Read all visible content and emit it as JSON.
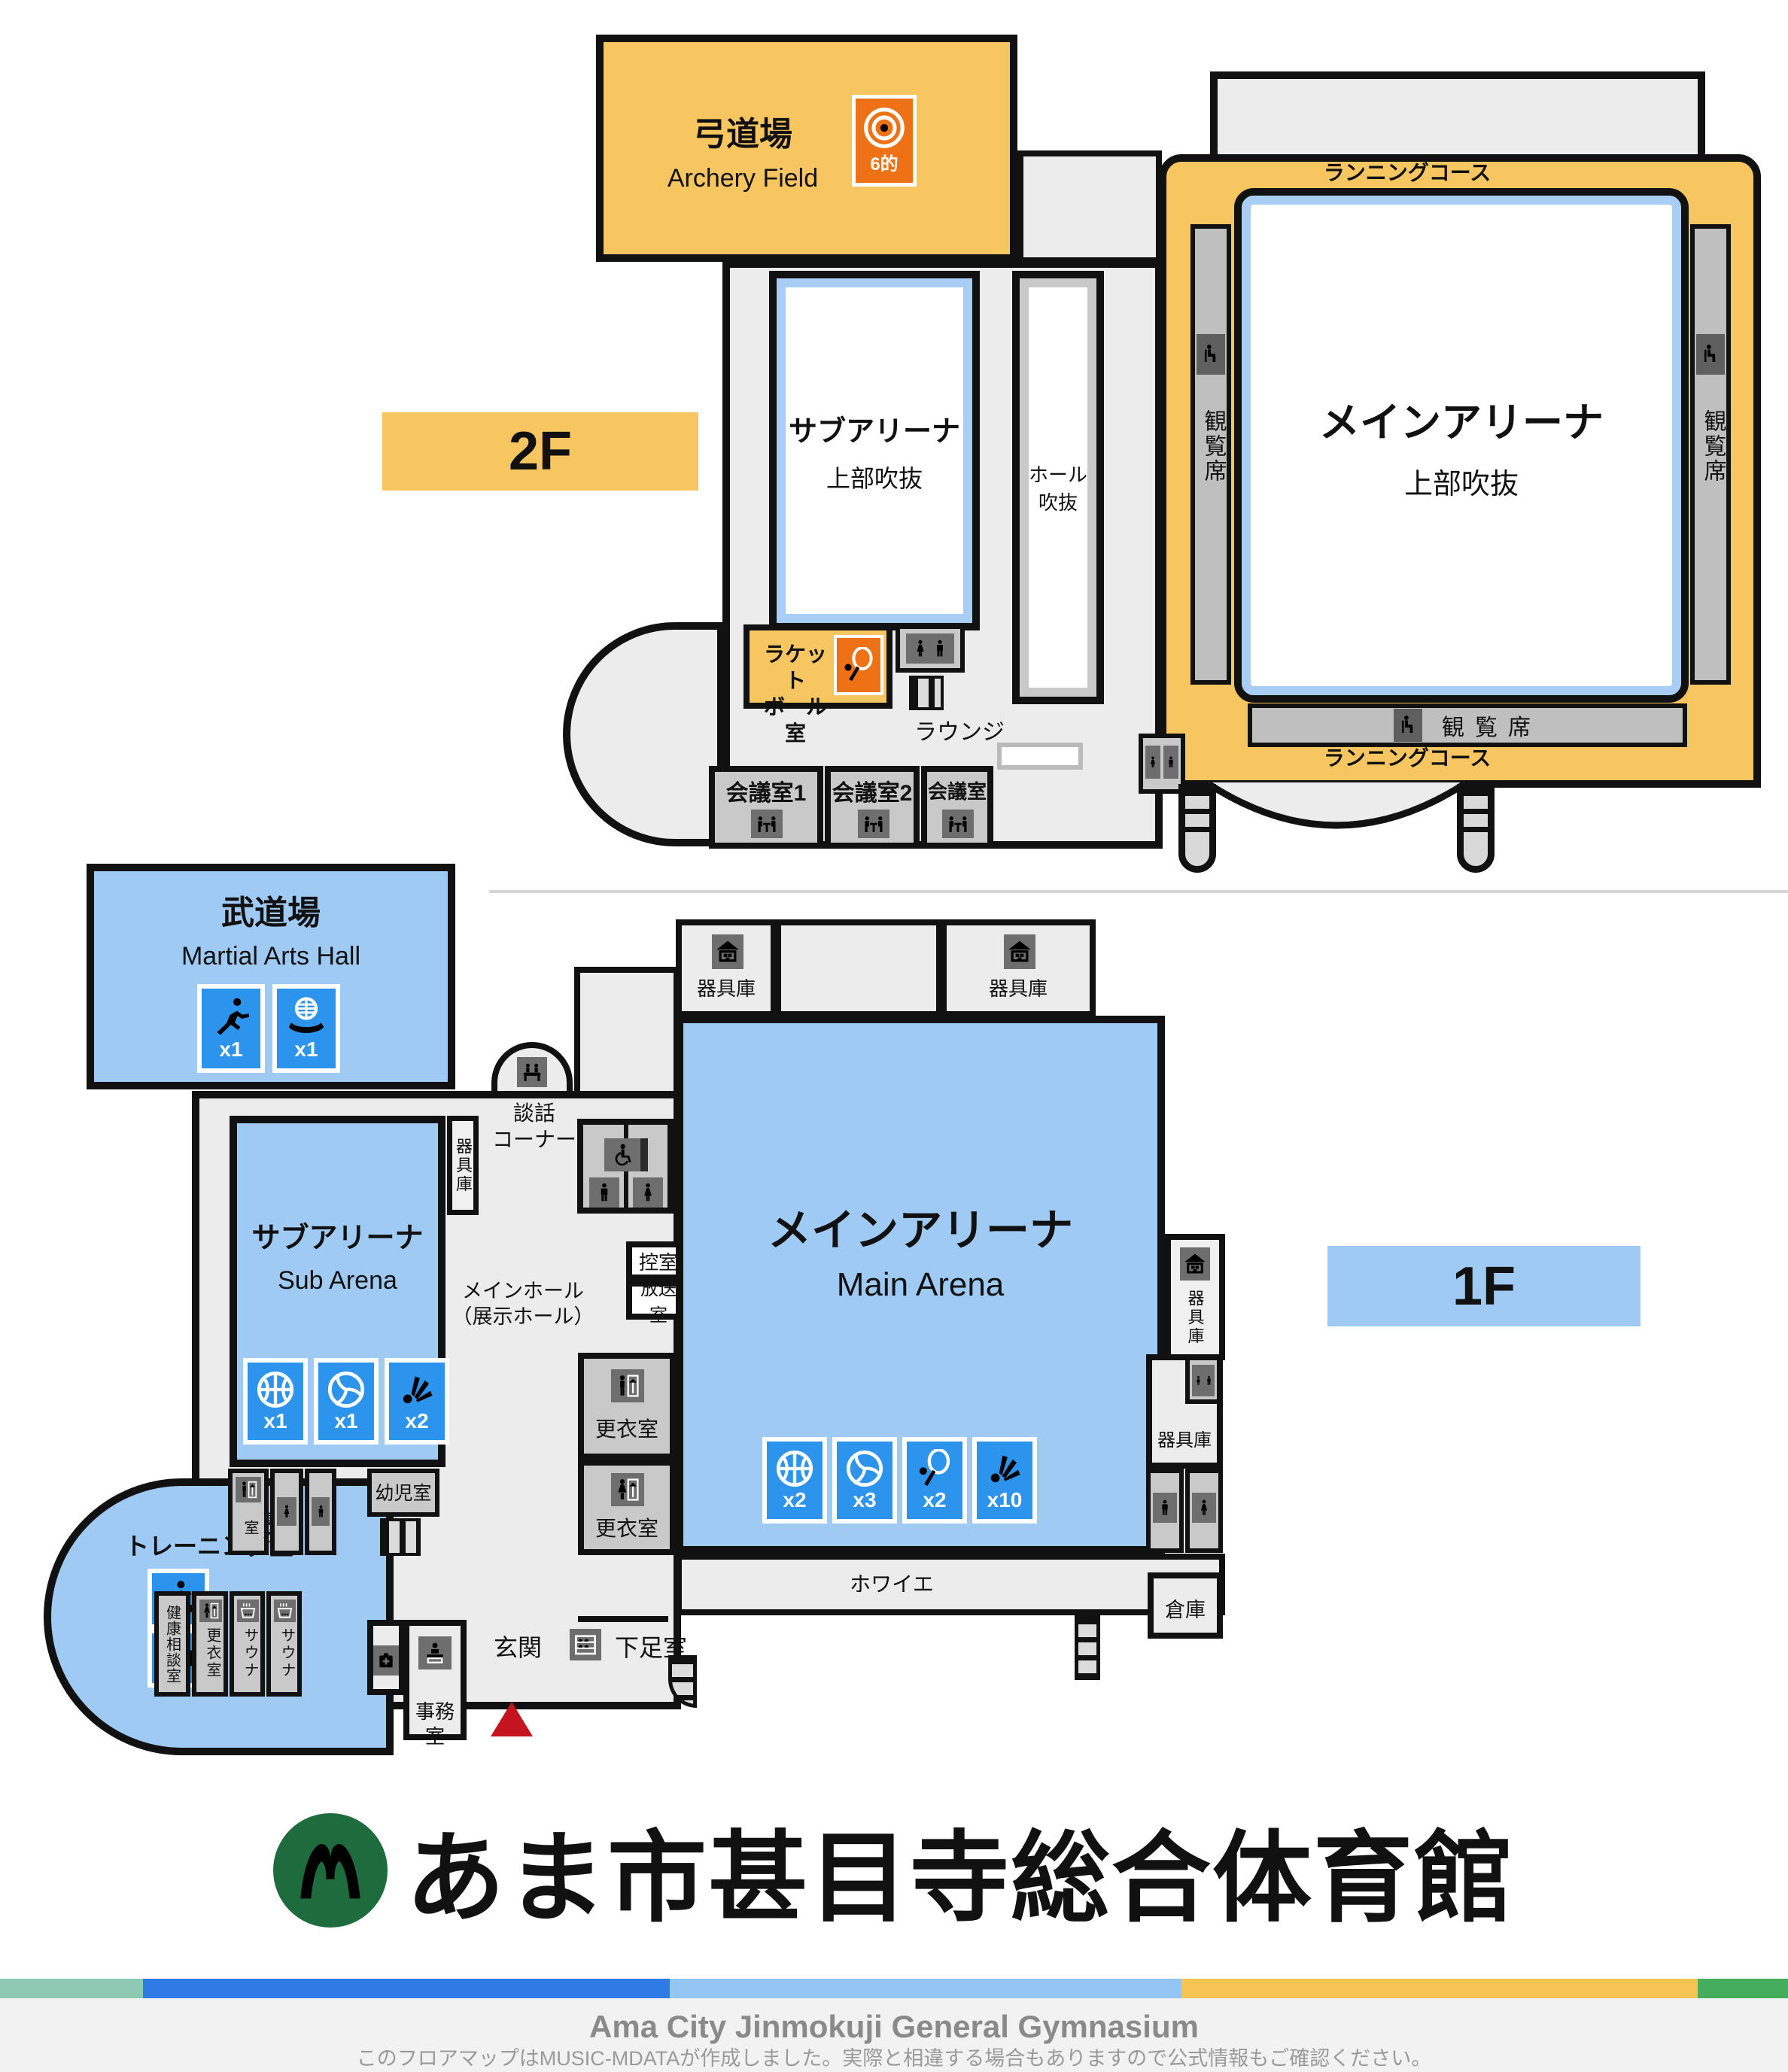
{
  "colors": {
    "room_orange": "#F8C661",
    "icon_orange": "#EE7115",
    "room_blue": "#9FCAF3",
    "icon_blue": "#2D94EE",
    "floor_gray": "#ECECEC",
    "small_room_gray": "#C9C9C9",
    "wall": "#111111",
    "void_blue_border": "#A8CEF5",
    "logo_green": "#1E6B3E",
    "stripe": [
      "#8FC9B4",
      "#2E7BE5",
      "#93C6F2",
      "#F6C453",
      "#44AE5C"
    ]
  },
  "f2": {
    "floor_label": "2F",
    "archery": {
      "name": "弓道場",
      "en": "Archery Field",
      "target_count": "6的"
    },
    "sub_arena_void": {
      "name": "サブアリーナ",
      "note": "上部吹抜"
    },
    "hall_void": {
      "line1": "ホール",
      "line2": "吹抜"
    },
    "racquetball": {
      "line1": "ラケット",
      "line2": "ボール室"
    },
    "lounge_label": "ラウンジ",
    "meeting1": "会議室1",
    "meeting2": "会議室2",
    "meeting3": "会議室",
    "main_arena_void": {
      "name": "メインアリーナ",
      "note": "上部吹抜"
    },
    "running_course": "ランニングコース",
    "seats": "観覧席"
  },
  "f1": {
    "floor_label": "1F",
    "budokan": {
      "name": "武道場",
      "en": "Martial Arts Hall",
      "judo_count": "x1",
      "kendo_count": "x1"
    },
    "sub_arena": {
      "name": "サブアリーナ",
      "en": "Sub Arena",
      "basketball_count": "x1",
      "volleyball_count": "x1",
      "badminton_count": "x2"
    },
    "main_arena": {
      "name": "メインアリーナ",
      "en": "Main Arena",
      "basketball_count": "x2",
      "volleyball_count": "x3",
      "tennis_count": "x2",
      "badminton_count": "x10"
    },
    "main_hall": {
      "line1": "メインホール",
      "line2": "（展示ホール）"
    },
    "danwa": {
      "line1": "談話",
      "line2": "コーナー"
    },
    "kigu": "器具庫",
    "hikae": "控室",
    "broadcast": "放送室",
    "koui": "更衣室",
    "yoji": "幼児室",
    "training": "トレーニング室",
    "health": "健康相談室",
    "sauna": "サウナ",
    "office": "事務室",
    "entrance": "玄関",
    "shoe": "下足室",
    "foyer": "ホワイエ",
    "souko": "倉庫"
  },
  "footer": {
    "title": "あま市甚目寺総合体育館",
    "en_title": "Ama City Jinmokuji General Gymnasium",
    "note": "このフロアマップはMUSIC-MDATAが作成しました。実際と相違する場合もありますので公式情報もご確認ください。"
  }
}
